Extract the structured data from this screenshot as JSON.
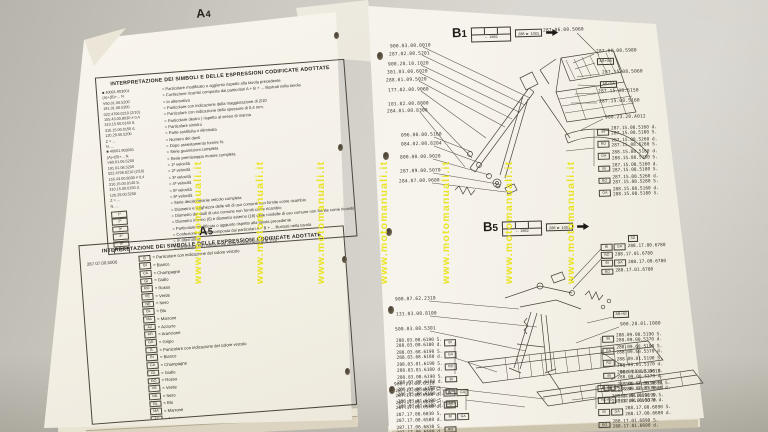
{
  "watermark": {
    "text": "www.motomanuali.it",
    "color": "#e9e312"
  },
  "left_page": {
    "a4": {
      "title_letter": "A",
      "title_digit": "4",
      "box_header": "INTERPRETAZIONE DEI SIMBOLI E DELLE ESPRESSIONI CODIFICATE ADOTTATE",
      "codes": [
        "■ 40001.903001",
        "(A)+(B)+... N",
        "V60.01.06.5200",
        "191.01.08.5200",
        "022.4706.0210 (2/10)",
        "155.43.00.8030 ≠ 0,4",
        "310.15.00.0140 S.",
        "310.15.00.0150 d.",
        "120.29.00.5200",
        "Z = ...",
        "N. ..."
      ],
      "symbols": [
        "1ª",
        "2ª",
        "3ª",
        "4ª",
        "5ª",
        "6ª",
        "S",
        "SD",
        "M 6x16",
        "M 6",
        "Ø 6x18"
      ],
      "items": [
        "= Particolare modificato o aggiunto rispetto alla tavola precedente",
        "= Confezione ricambi composta dai particolari A + B + ... illustrati nella tavola",
        "= In alternativa",
        "= Particolare con indicazione della maggiorazione di 2/10",
        "= Particolare con indicazione dello spessore di 0,4 mm.",
        "= Particolare destro   } rispetto al senso di marcia",
        "= Particolare sinistro",
        "= Parte sostituita o eliminata",
        "= Numero dei denti",
        "= Dopo assestamento fornire N.",
        "= Serie guarnizioni completa",
        "= Serie premistoppa motore completa",
        "= 1ª velocità",
        "= 2ª velocità",
        "= 3ª velocità",
        "= 4ª velocità",
        "= 5ª velocità",
        "= 6ª velocità",
        "= Serie decalcomanie veicolo completa",
        "= Diametro e lunghezza delle viti di uso comune non fornite come ricambio",
        "= Diametro dei dadi di uso comune non forniti come ricambio",
        "= Diametro interno (6) e diametro esterno (18) delle rondelle di uso comune non fornite come ricambio"
      ]
    },
    "a5": {
      "title_letter": "A",
      "title_digit": "5",
      "box_header": "INTERPRETAZIONE DEI SIMBOLI E DELLE ESPRESSIONI CODIFICATE ADOTTATE",
      "ref_code": "287.07.00.5000",
      "colors": [
        {
          "code": "B",
          "name": "= Particolare con indicazione del colore veicolo"
        },
        {
          "code": "BI",
          "name": "= Bianco"
        },
        {
          "code": "CA",
          "name": "= Champagne"
        },
        {
          "code": "GI",
          "name": "= Giallo"
        },
        {
          "code": "RO",
          "name": "= Rosso"
        },
        {
          "code": "VE",
          "name": "= Verde"
        },
        {
          "code": "NE",
          "name": "= Nero"
        },
        {
          "code": "BL",
          "name": "= Blu"
        },
        {
          "code": "MA",
          "name": "= Marrone"
        },
        {
          "code": "AZ",
          "name": "= Azzurro"
        },
        {
          "code": "AR",
          "name": "= Arancione"
        },
        {
          "code": "GR",
          "name": "= Grigio"
        }
      ]
    }
  },
  "right_page": {
    "b1": {
      "title_letter": "B",
      "title_digit": "1",
      "validity": "← 1982",
      "range": "288 ► 1001",
      "left_labels": [
        "900.03.00.0010",
        "287.02.00.5201",
        "900.28.10.1020",
        "301.03.00.6020",
        "288.01.09.5020",
        "177.02.00.9060",
        "101.02.00.8800",
        "284.01.00.8300",
        "096.00.00.5160",
        "084.02.00.8204",
        "800.00.00.9020",
        "287.09.00.5070",
        "284.07.00.9600"
      ],
      "right_labels": [
        "287.06.00.5060",
        "287.06.00.5980",
        "287.15.08.5060",
        "287.15.08.5150",
        "287.15.00.5160",
        "900.23.20.A012"
      ],
      "right_boxes": [
        "AB+GA",
        "AB+GA"
      ],
      "variants": [
        {
          "codes": [
            "BI"
          ],
          "lines": [
            "287.15.08.5160 d.",
            "287.15.08.5180 S."
          ]
        },
        {
          "codes": [
            "RO"
          ],
          "lines": [
            "287.15.08.5260 d.",
            "287.15.08.5280 S."
          ]
        },
        {
          "codes": [
            "GA"
          ],
          "lines": [
            "288.15.08.5160 d.",
            "288.15.08.5180 S."
          ]
        }
      ]
    },
    "b5": {
      "title_letter": "B",
      "title_digit": "5",
      "validity": "← 1982",
      "range": "288 ► 1001",
      "top_right_box": "3D",
      "top_right_variants": [
        {
          "codes": [
            "BI",
            "GA"
          ],
          "lines": [
            "288.17.00.6780"
          ]
        },
        {
          "codes": [
            "RO"
          ],
          "lines": [
            "288.17.01.6780"
          ]
        }
      ],
      "mid_right_box": "AB+60",
      "mid_right_label": "900.28.01.1080",
      "left_labels": [
        "900.07.62.2310",
        "131.03.00.8100",
        "500.03.00.5301"
      ],
      "left_variants": [
        {
          "codes": [
            "BI"
          ],
          "lines": [
            "288.03.00.6190 S.",
            "288.03.00.6180 d."
          ]
        },
        {
          "codes": [
            "GA"
          ],
          "lines": [
            "288.03.68.6190 S.",
            "288.03.68.6180 d."
          ]
        },
        {
          "codes": [
            "RO"
          ],
          "lines": [
            "288.03.01.6190 S.",
            "288.03.01.6180 d."
          ]
        }
      ],
      "left_label2": "900.22.60.0510",
      "left_variants2": [
        {
          "codes": [
            "BI",
            "GA"
          ],
          "lines": [
            "287.17.08.6830 S.",
            "287.17.00.6580 d."
          ]
        },
        {
          "codes": [
            "RO"
          ],
          "lines": [
            "287.17.06.6830 S.",
            "287.17.06.6580 d."
          ]
        }
      ],
      "right_variants": [
        {
          "codes": [
            "BI"
          ],
          "lines": [
            "288.09.00.5190 S.",
            "288.09.00.5370 d."
          ]
        },
        {
          "codes": [
            "GA"
          ],
          "lines": [
            "288.09.68.5190 S.",
            "288.09.68.5370 d."
          ]
        },
        {
          "codes": [
            "RO"
          ],
          "lines": [
            "288.09.01.5190 S.",
            "288.09.01.5370 d."
          ]
        }
      ],
      "right_label2": "900.28.60.0610",
      "right_variants2": [
        {
          "codes": [
            "BI",
            "GA"
          ],
          "lines": [
            "288.17.08.6890 S.",
            "288.17.00.6600 d."
          ]
        },
        {
          "codes": [
            "RO"
          ],
          "lines": [
            "288.17.01.6890 S.",
            "288.17.01.6600 d."
          ]
        }
      ]
    }
  }
}
